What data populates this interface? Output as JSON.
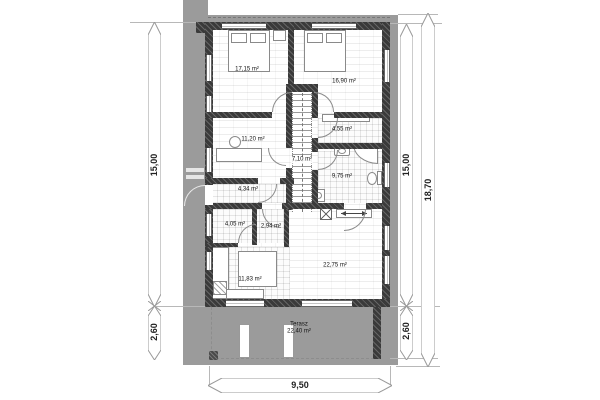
{
  "rooms": [
    {
      "name": "bedroom-1",
      "area": "17,15 m²"
    },
    {
      "name": "bedroom-2",
      "area": "16,90 m²"
    },
    {
      "name": "office",
      "area": "11,20 m²"
    },
    {
      "name": "wardrobe",
      "area": "4,55 m²"
    },
    {
      "name": "stair-hall",
      "area": "7,10 m²"
    },
    {
      "name": "bathroom",
      "area": "9,75 m²"
    },
    {
      "name": "hall",
      "area": "4,34 m²"
    },
    {
      "name": "pantry",
      "area": "4,05 m²"
    },
    {
      "name": "wc",
      "area": "2,94 m²"
    },
    {
      "name": "living-room",
      "area": "22,75 m²"
    },
    {
      "name": "kitchen",
      "area": "11,83 m²"
    }
  ],
  "terrace": {
    "label": "Terasz",
    "area": "22,40 m²"
  },
  "dimensions": {
    "left_main": "15,00",
    "left_lower": "2,60",
    "right_main": "15,00",
    "right_lower": "2,60",
    "right_total": "18,70",
    "bottom": "9,50"
  },
  "colors": {
    "site_gray": "#9b9b9b",
    "wall": "#3a3a3a",
    "dim_line": "#999999"
  }
}
